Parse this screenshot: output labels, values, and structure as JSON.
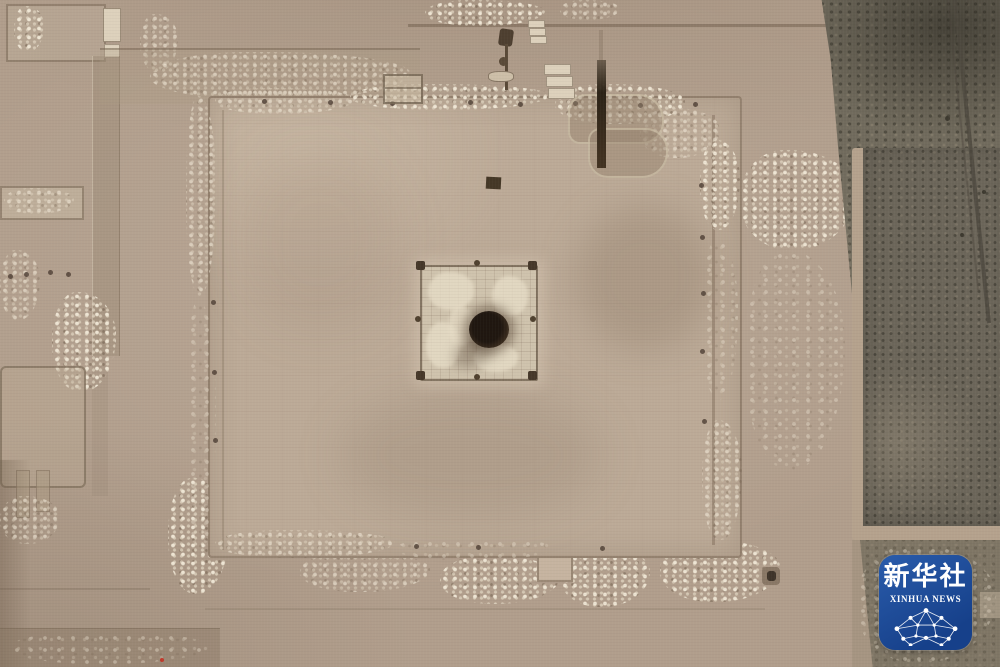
{
  "watermark": {
    "cn": "新华社",
    "en": "XINHUA NEWS"
  },
  "palette": {
    "ground": "#b19e8c",
    "ground_shadow": "#9c8a78",
    "platform": "#bcaa97",
    "platform_light": "#c6b4a0",
    "rubble_light": "#ddd1bc",
    "earth_line": "#8a7764",
    "pit_floor": "#cfc3ad",
    "pit_plaster": "#e6dcc6",
    "hole_dark": "#201710",
    "veg_strip": "#716b5d",
    "veg_field": "#6c665a",
    "field_border": "#b5a28d",
    "track_line": "#4e483e",
    "marker_red": "#c0392b",
    "logo_blue_top": "#2a5cab",
    "logo_blue_bottom": "#16408a",
    "logo_text": "#ffffff"
  }
}
